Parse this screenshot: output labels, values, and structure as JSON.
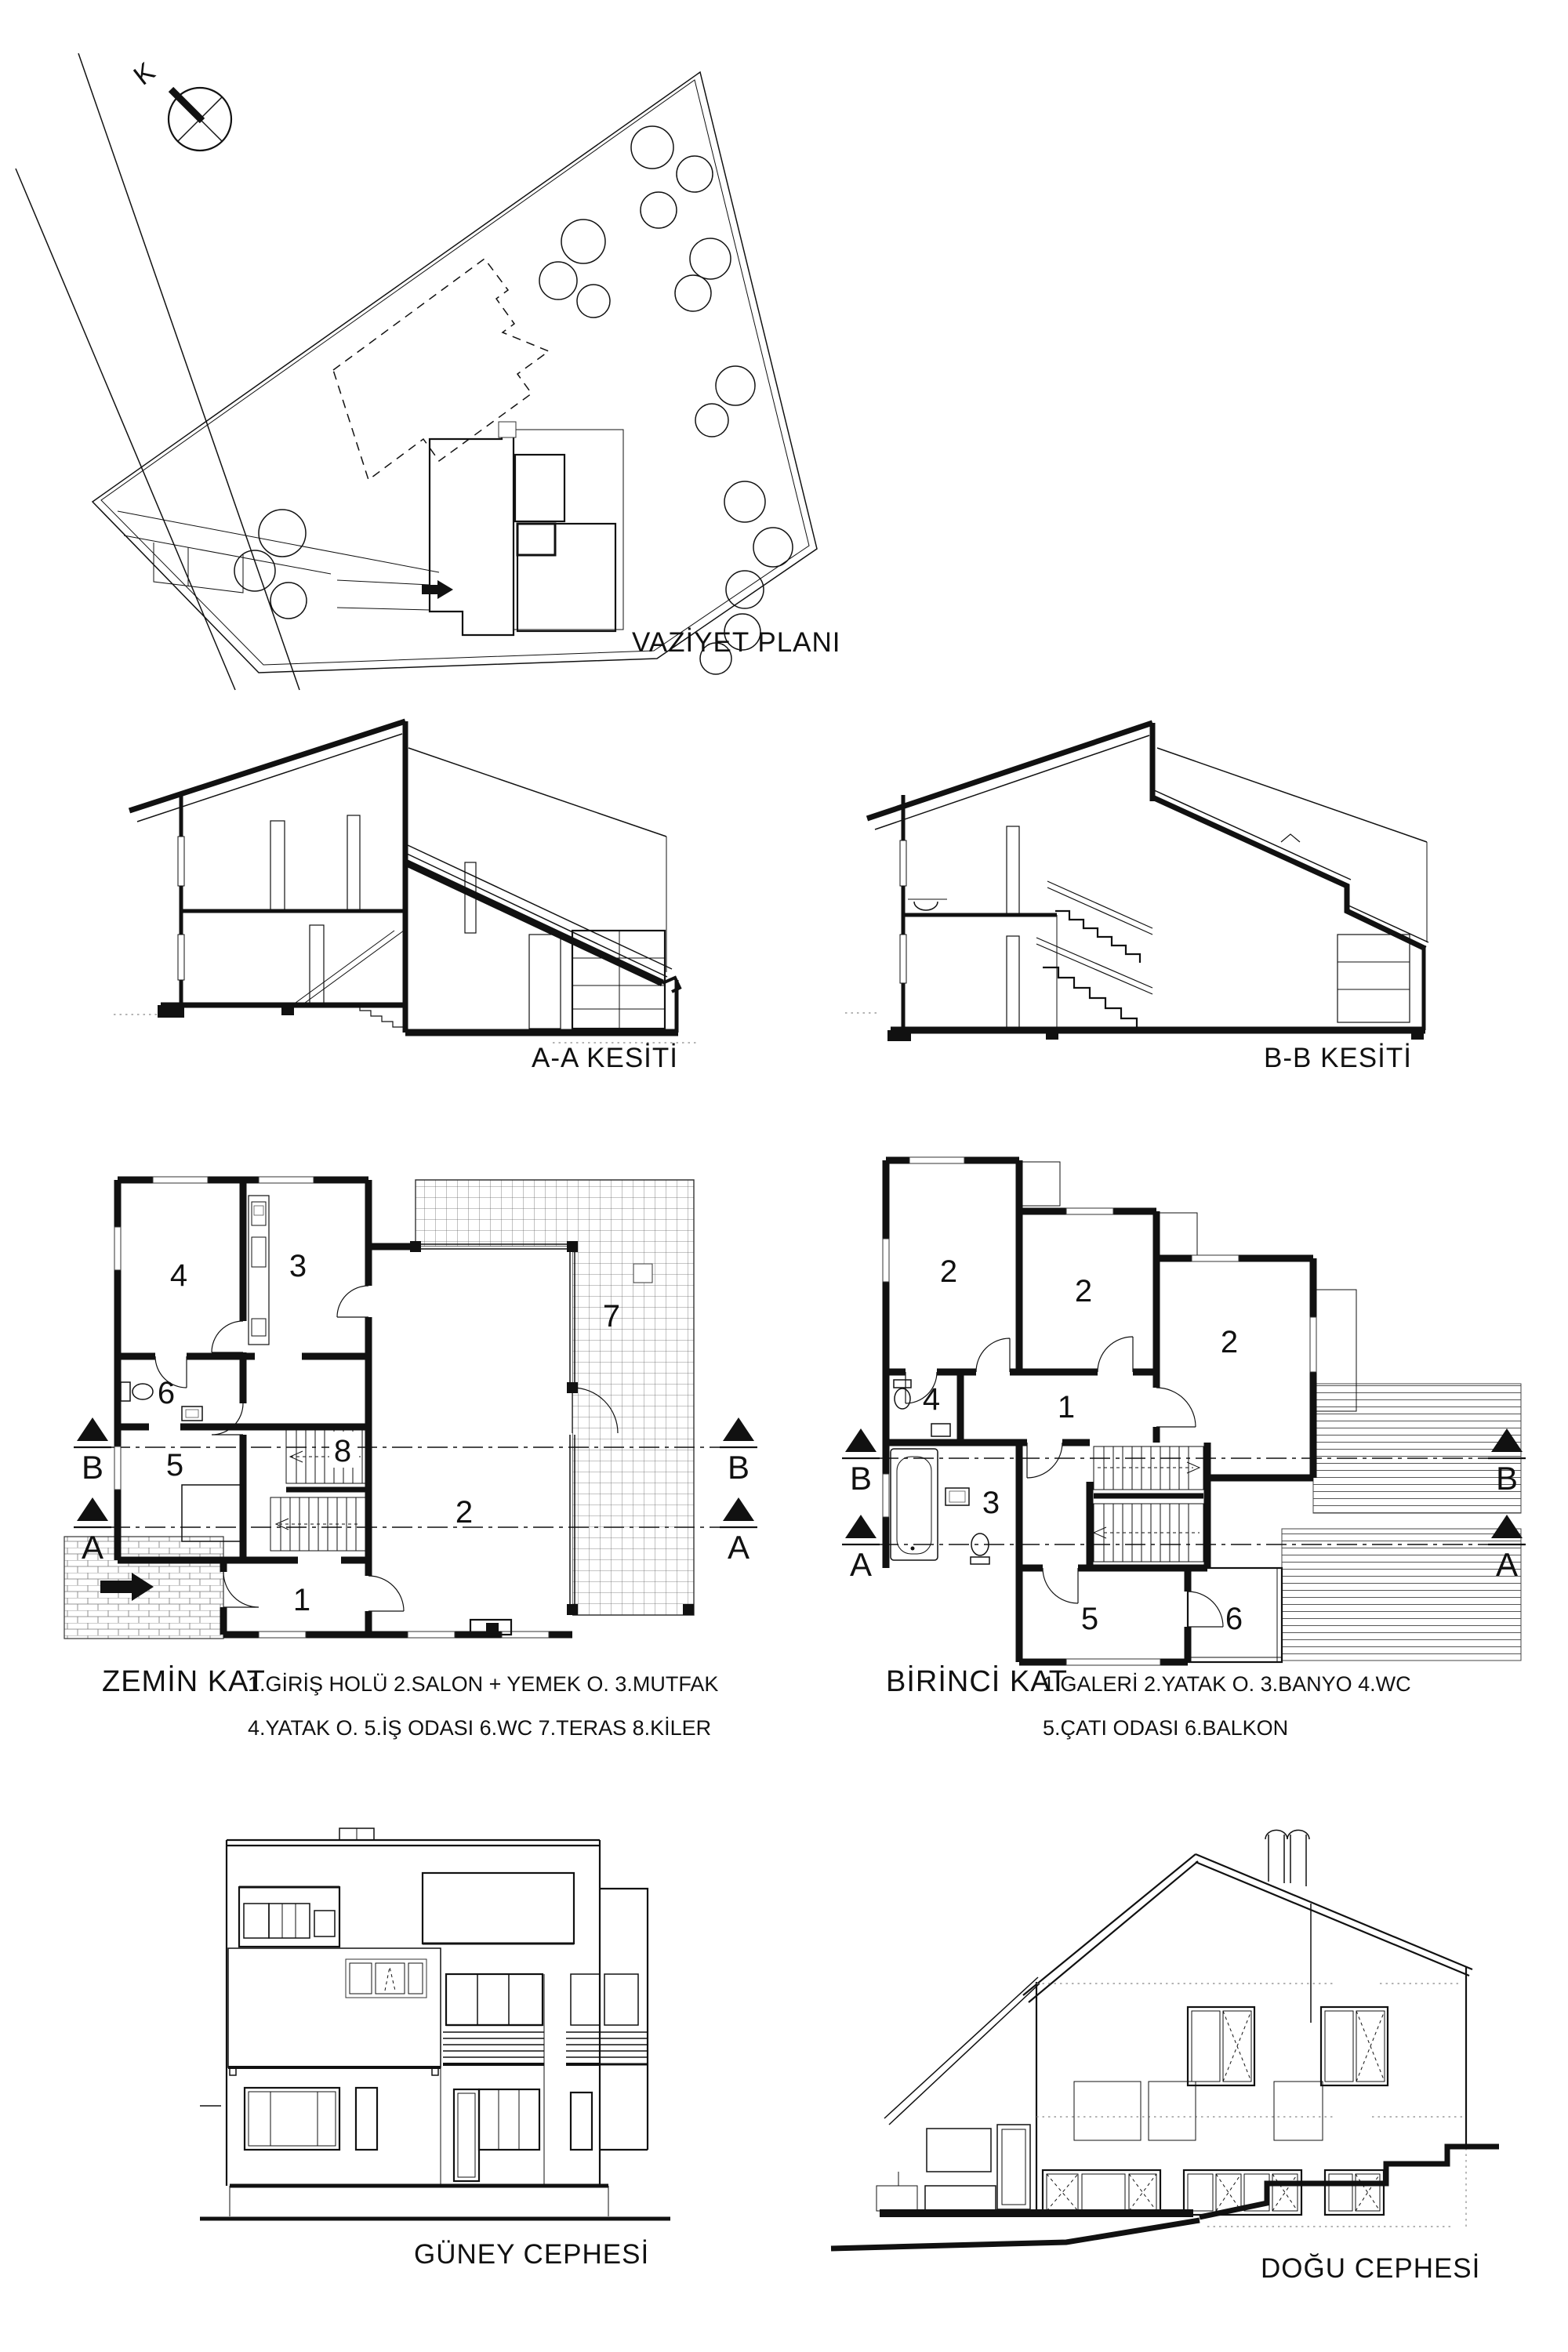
{
  "sheet": {
    "background": "#ffffff",
    "ink": "#111111"
  },
  "site_plan": {
    "title": "VAZİYET PLANI",
    "north_label": "K"
  },
  "sections": {
    "a_title": "A-A KESİTİ",
    "b_title": "B-B KESİTİ"
  },
  "ground_floor": {
    "title": "ZEMİN KAT",
    "legend_line1": "1.GİRİŞ HOLÜ 2.SALON + YEMEK O. 3.MUTFAK",
    "legend_line2": "4.YATAK O. 5.İŞ ODASI 6.WC 7.TERAS 8.KİLER",
    "rooms": {
      "entry_hall": "1",
      "living_dining": "2",
      "kitchen": "3",
      "bedroom": "4",
      "office": "5",
      "wc": "6",
      "terrace": "7",
      "pantry": "8"
    },
    "markers": {
      "b": "B",
      "a": "A"
    }
  },
  "first_floor": {
    "title": "BİRİNCİ KAT",
    "legend_line1": "1.GALERİ 2.YATAK O. 3.BANYO 4.WC",
    "legend_line2": "5.ÇATI ODASI 6.BALKON",
    "rooms": {
      "gallery": "1",
      "bedroom_a": "2",
      "bedroom_b": "2",
      "bedroom_c": "2",
      "bathroom": "3",
      "wc": "4",
      "attic_room": "5",
      "balcony": "6"
    },
    "markers": {
      "b": "B",
      "a": "A"
    }
  },
  "elevations": {
    "south_title": "GÜNEY CEPHESİ",
    "east_title": "DOĞU CEPHESİ"
  }
}
